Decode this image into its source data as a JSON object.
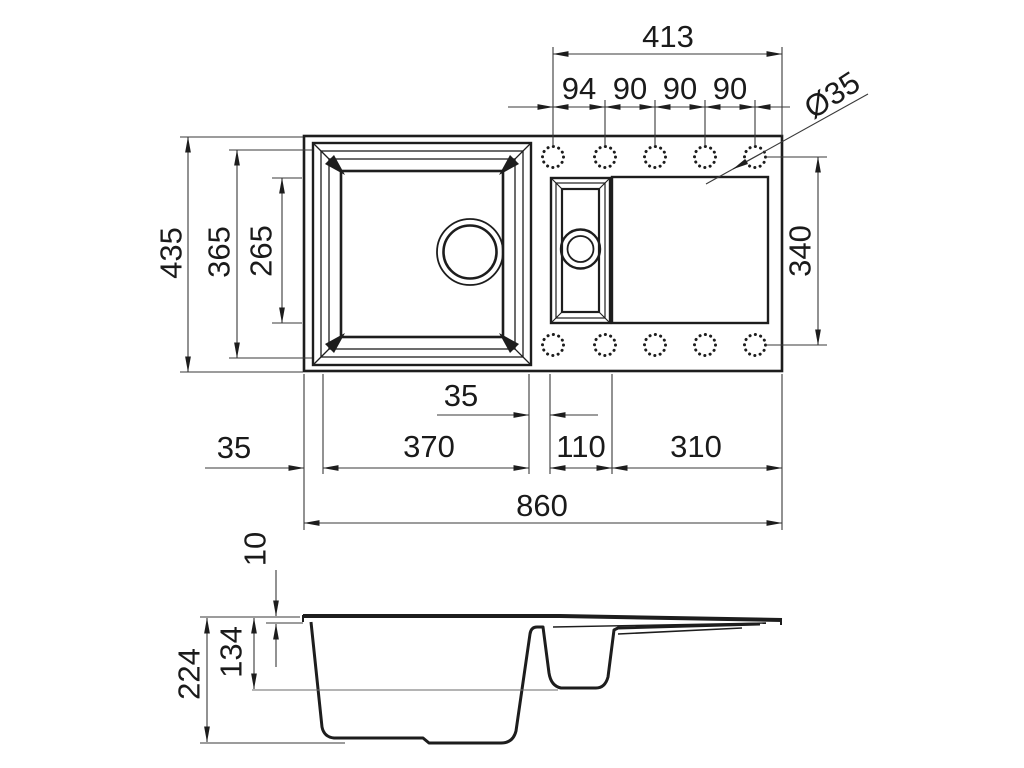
{
  "drawing_title": "Kitchen sink technical drawing, top view and section view",
  "colors": {
    "background": "#ffffff",
    "line": "#1d1d1d",
    "dimension_line": "#3a3a3a"
  },
  "dimensions": {
    "top_view": {
      "faucet_hole_span": "413",
      "faucet_hole_pitches": [
        "94",
        "90",
        "90",
        "90"
      ],
      "faucet_hole_diameter": "Ø35",
      "overall_depth": "435",
      "main_bowl_outer_depth": "365",
      "main_bowl_inner_depth": "265",
      "drainer_depth": "340",
      "left_rim_offset": "35",
      "main_bowl_length": "370",
      "bowl_gap": "35",
      "half_bowl_length": "110",
      "drainer_length": "310",
      "overall_length": "860"
    },
    "section_view": {
      "rim_thickness": "10",
      "half_bowl_depth": "134",
      "main_bowl_depth": "224"
    }
  }
}
